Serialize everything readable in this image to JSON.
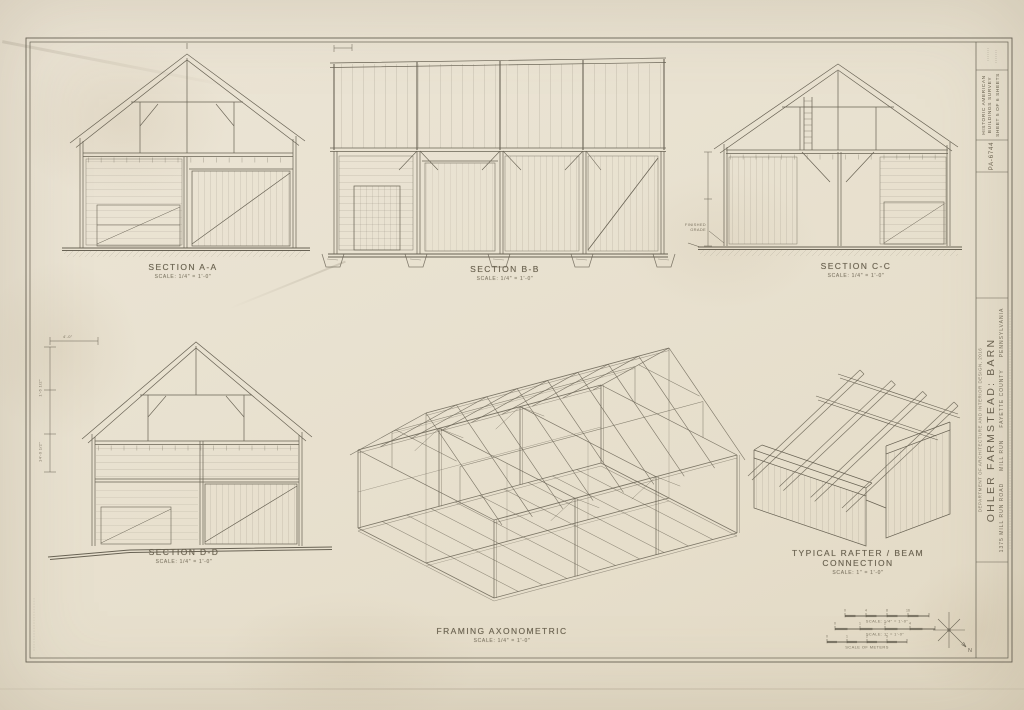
{
  "titleblock": {
    "survey_line1": "HISTORIC AMERICAN",
    "survey_line2": "BUILDINGS SURVEY",
    "sheet_line": "SHEET 5 OF 6 SHEETS",
    "survey_no": "PA-6744",
    "credit": "DEPARTMENT OF ARCHITECTURE AND INTERIOR DESIGN, 2016",
    "structure_name": "OHLER FARMSTEAD: BARN",
    "address": "1375 MILL RUN ROAD",
    "town": "MILL RUN",
    "county": "FAYETTE COUNTY",
    "state": "PENNSYLVANIA"
  },
  "drawings": {
    "section_aa": {
      "title": "SECTION A-A",
      "scale": "SCALE: 1/4\" = 1'-0\""
    },
    "section_bb": {
      "title": "SECTION B-B",
      "scale": "SCALE: 1/4\" = 1'-0\""
    },
    "section_cc": {
      "title": "SECTION C-C",
      "scale": "SCALE: 1/4\" = 1'-0\""
    },
    "section_dd": {
      "title": "SECTION D-D",
      "scale": "SCALE: 1/4\" = 1'-0\""
    },
    "axon": {
      "title": "FRAMING AXONOMETRIC",
      "scale": "SCALE: 1/4\" = 1'-0\""
    },
    "detail": {
      "title": "TYPICAL RAFTER / BEAM",
      "title2": "CONNECTION",
      "scale": "SCALE: 1\" = 1'-0\""
    }
  },
  "annotations": {
    "finished_grade_1": "FINISHED",
    "finished_grade_2": "GRADE",
    "dim_top": "4'-0\"",
    "dim_mid": "1'-6 1/2\"",
    "dim_bot": "14'-0 1/2\""
  },
  "scalebars": {
    "north_label": "N",
    "bars": [
      {
        "label": "SCALE: 1/4\" = 1'-0\"",
        "ticks": [
          "0",
          "4",
          "8",
          "16"
        ]
      },
      {
        "label": "SCALE: 1\" = 1'-0\"",
        "ticks": [
          "0",
          "1",
          "2",
          "4"
        ]
      },
      {
        "label": "SCALE OF METERS",
        "ticks": [
          "0",
          "1",
          "2",
          "5"
        ]
      }
    ]
  }
}
